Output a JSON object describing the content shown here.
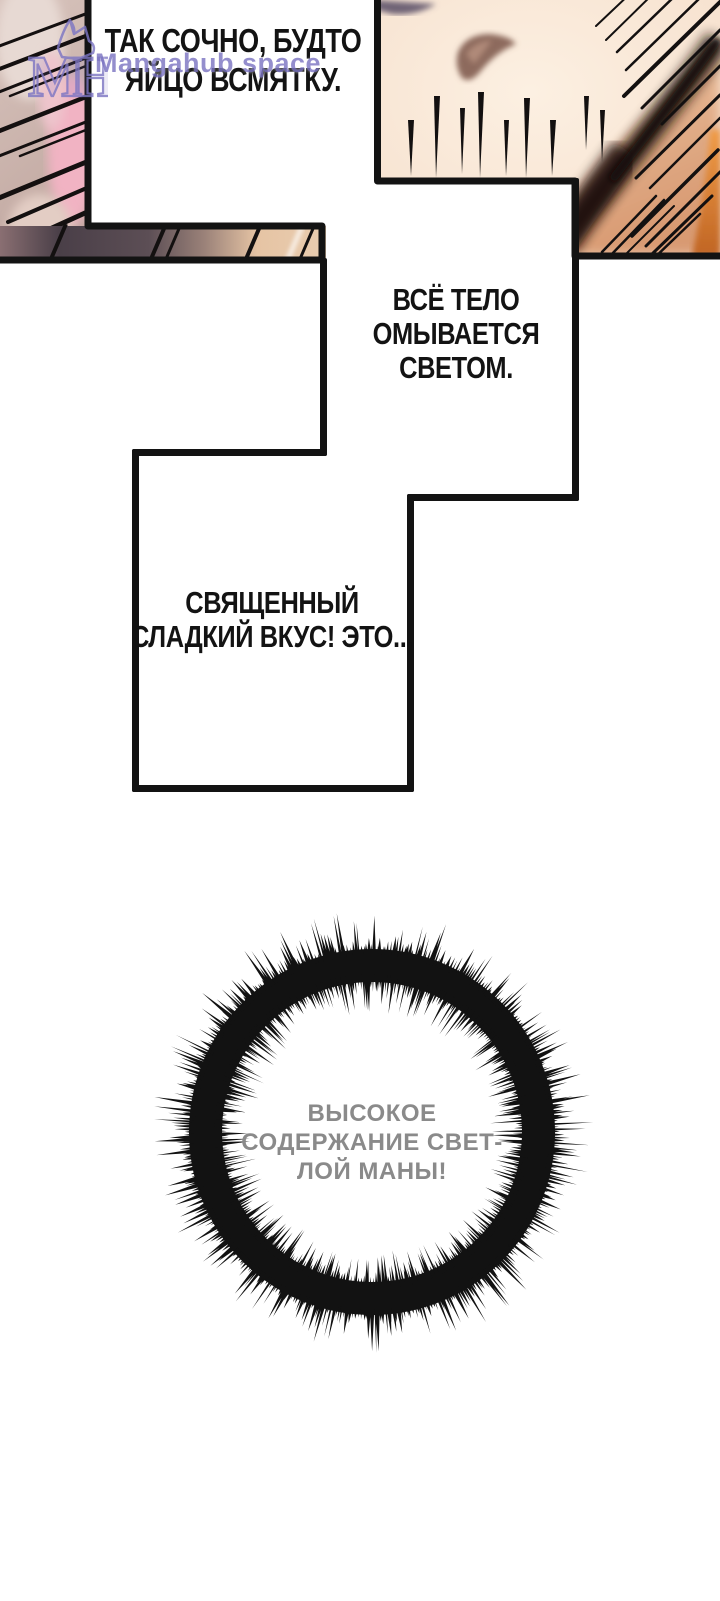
{
  "page": {
    "background": "#ffffff",
    "width": 720,
    "height": 1601
  },
  "watermark": {
    "site_name": "Mangahub space",
    "logo_monogram": "MH",
    "color": "#7d76c3"
  },
  "speech_bubbles": [
    {
      "id": "top",
      "text": "ТАК СОЧНО, БУДТО\nЯЙЦО ВСМЯТКУ."
    },
    {
      "id": "middle",
      "text": "ВСЁ ТЕЛО\nОМЫВАЕТСЯ\nСВЕТОМ."
    },
    {
      "id": "lower",
      "text": "СВЯЩЕННЫЙ\nСЛАДКИЙ ВКУС! ЭТО..."
    }
  ],
  "burst": {
    "text": "ВЫСОКОЕ\nСОДЕРЖАНИЕ СВЕТ-\nЛОЙ МАНЫ!",
    "text_color": "#8a8a8a",
    "ink_color": "#121212",
    "center_x": 372,
    "center_y": 1132,
    "inner_radius": 150,
    "band_outer_radius": 183,
    "max_spike_radius": 236,
    "outward_spikes": 420,
    "inward_spikes": 380
  },
  "palette": {
    "ink": "#131313",
    "skin": "#f9e8d9",
    "skin_shade": "#e2b292",
    "orange_accent": "#d8812f",
    "mauve": "#c2aaa3",
    "pink": "#f0b2c1",
    "band_dark": "#4a4049"
  }
}
